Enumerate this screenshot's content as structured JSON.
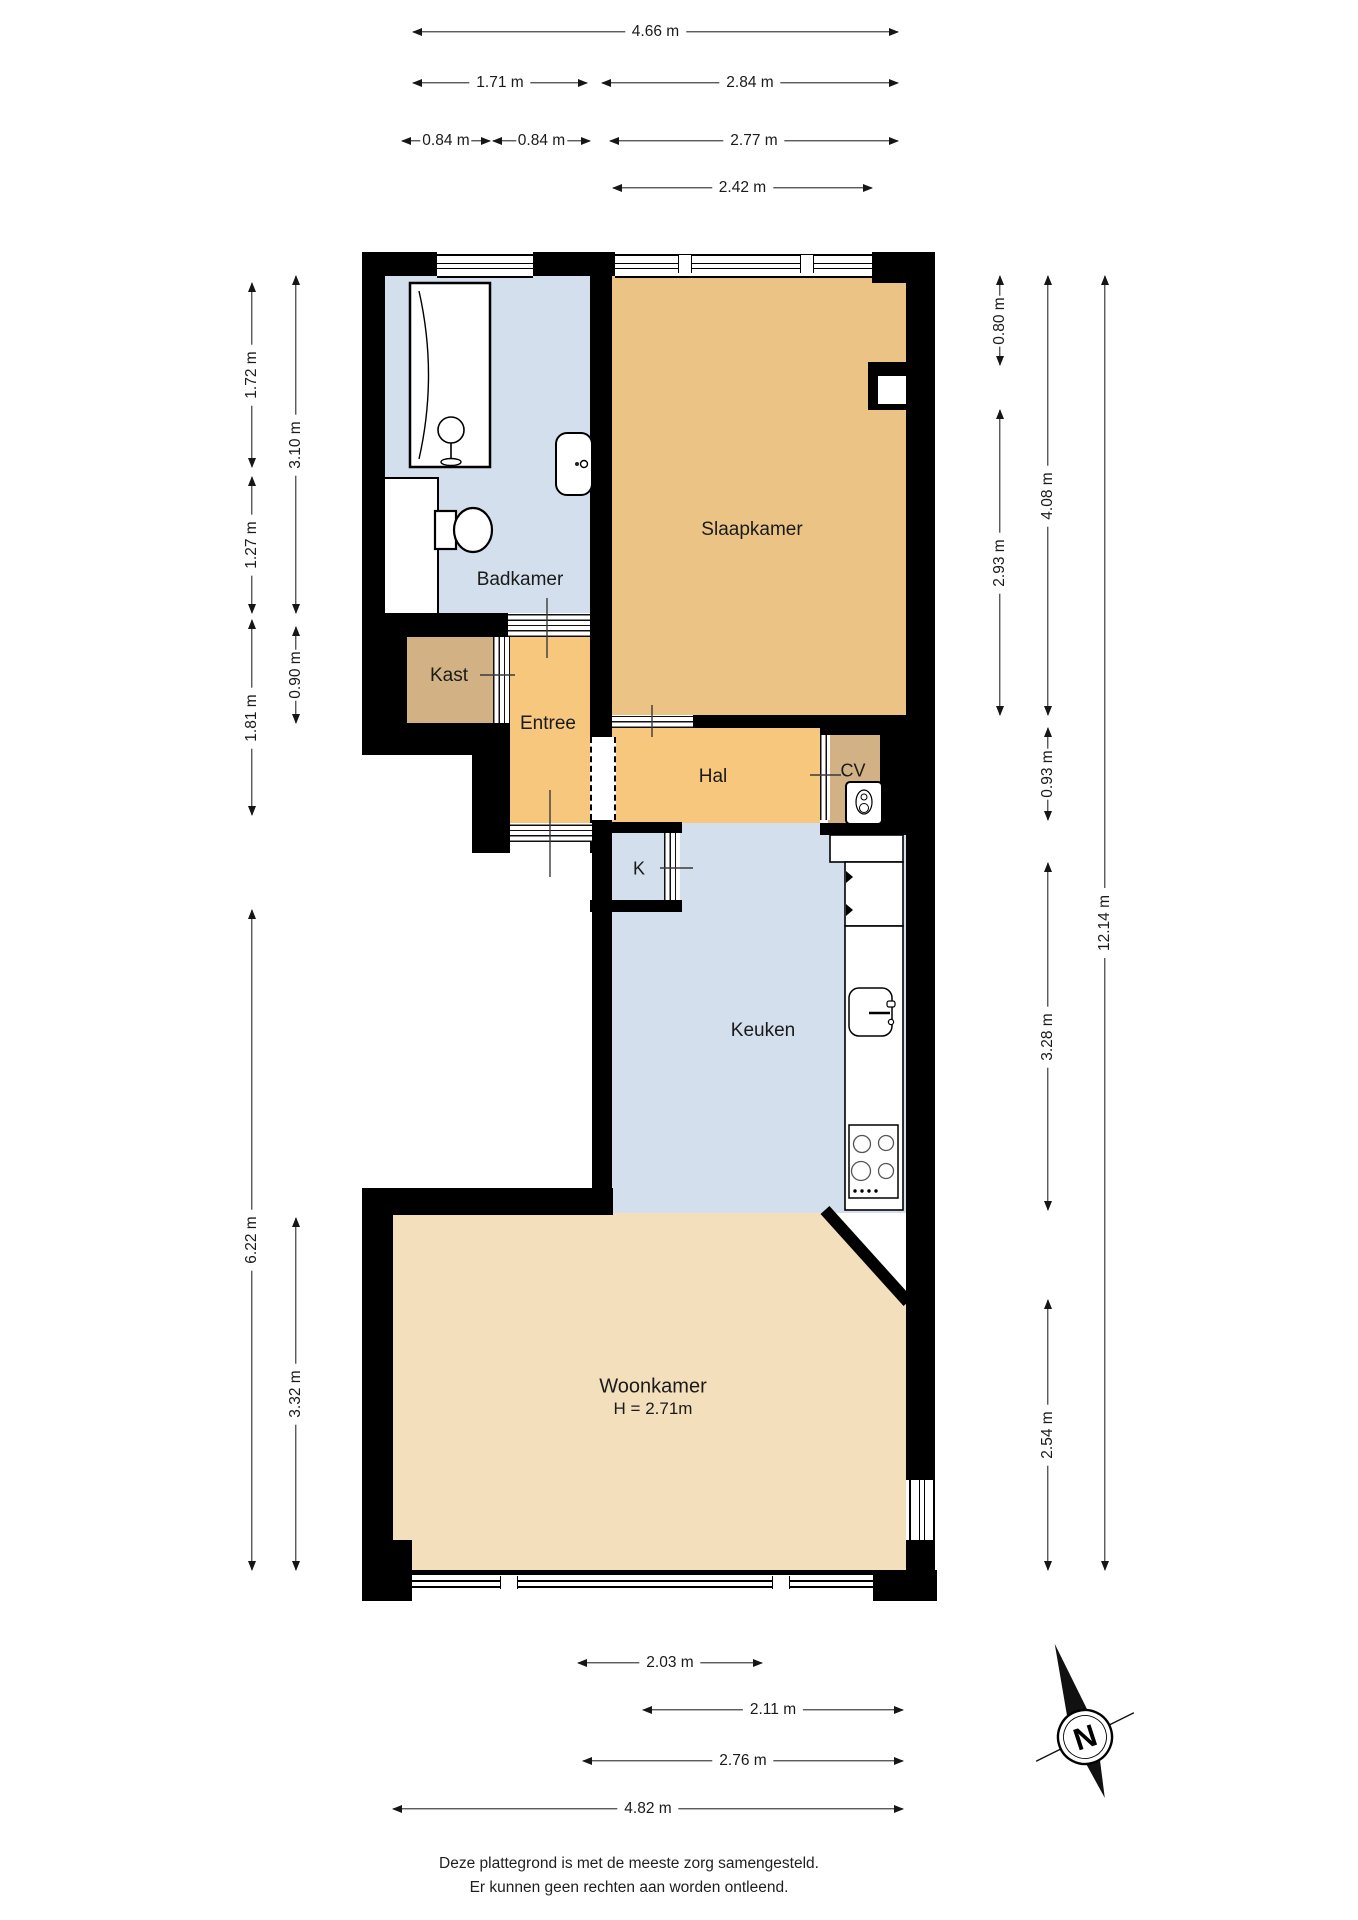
{
  "rooms": {
    "badkamer": "Badkamer",
    "slaapkamer": "Slaapkamer",
    "kast": "Kast",
    "entree": "Entree",
    "hal": "Hal",
    "cv": "CV",
    "k": "K",
    "keuken": "Keuken",
    "woonkamer": "Woonkamer",
    "woonkamer_ceiling": "H = 2.71m"
  },
  "dimensions": {
    "top": [
      "4.66 m",
      "1.71 m",
      "2.84 m",
      "0.84 m",
      "0.84 m",
      "2.77 m",
      "2.42 m"
    ],
    "left": [
      "1.72 m",
      "3.10 m",
      "1.27 m",
      "0.90 m",
      "1.81 m",
      "6.22 m",
      "3.32 m"
    ],
    "right": [
      "0.80 m",
      "2.93 m",
      "4.08 m",
      "0.93 m",
      "12.14 m",
      "3.28 m",
      "2.54 m"
    ],
    "bottom": [
      "2.03 m",
      "2.11 m",
      "2.76 m",
      "4.82 m"
    ]
  },
  "compass": {
    "north_label": "N"
  },
  "footer": {
    "line1": "Deze plattegrond is met de meeste zorg samengesteld.",
    "line2": "Er kunnen geen rechten aan worden ontleend."
  },
  "colors": {
    "wall": "#000000",
    "wet_room_blue": "#d3dfec",
    "bedroom_orange": "#ebc485",
    "hall_orange": "#f7c77d",
    "closet_tan": "#d2b285",
    "living_cream": "#f3dfbb"
  }
}
